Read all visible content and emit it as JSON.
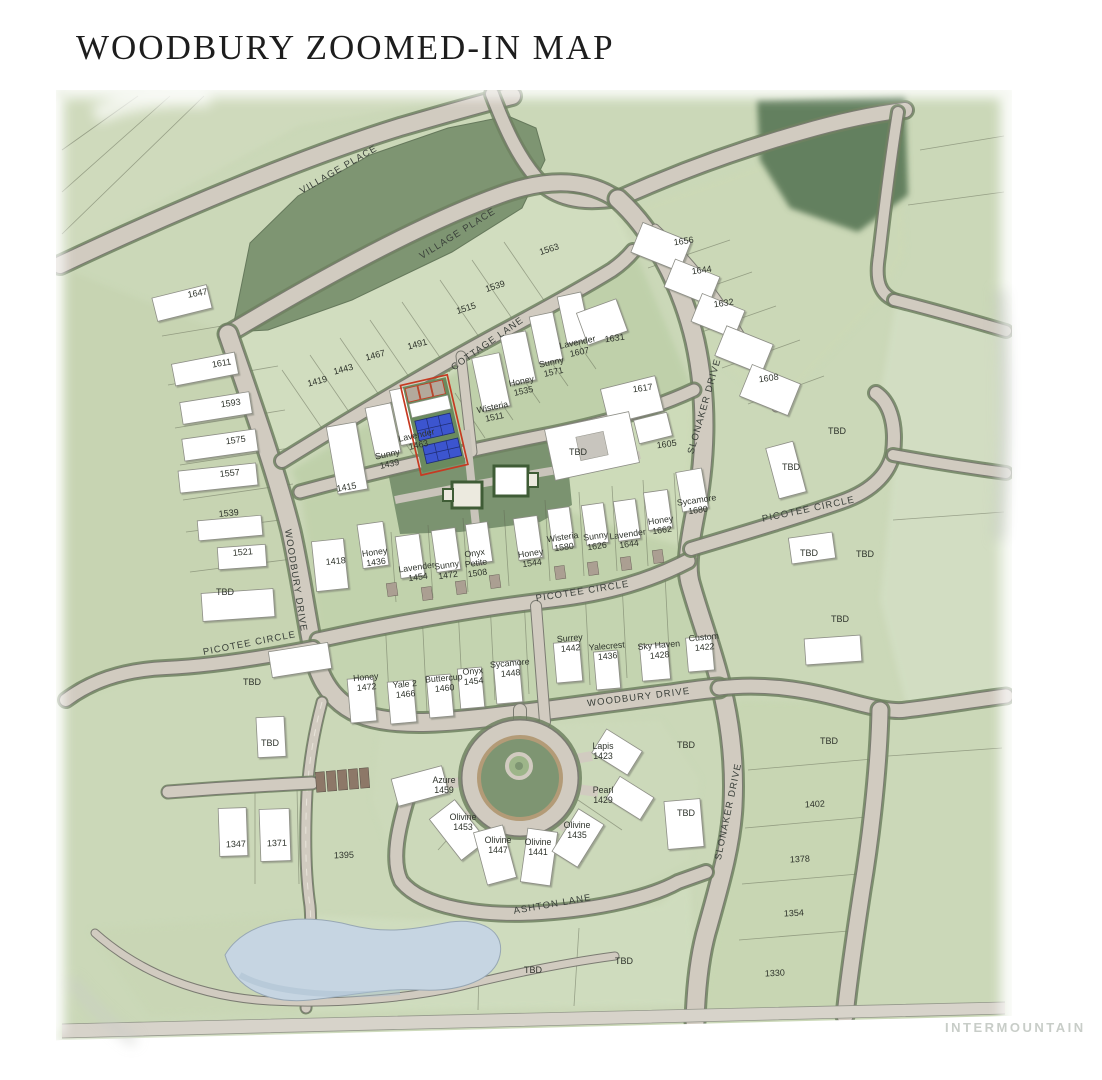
{
  "title": "WOODBURY ZOOMED-IN MAP",
  "watermark": "INTERMOUNTAIN",
  "map": {
    "tbd_label": "TBD",
    "streets": {
      "village_place": "VILLAGE PLACE",
      "cottage_lane": "COTTAGE LANE",
      "slonaker_drive": "SLONAKER DRIVE",
      "woodbury_drive": "WOODBURY DRIVE",
      "picotee_circle": "PICOTEE CIRCLE",
      "ashton_lane": "ASHTON LANE"
    },
    "numbered_lots": {
      "west_column": [
        "1647",
        "1611",
        "1593",
        "1575",
        "1557",
        "1539",
        "1521"
      ],
      "north_fan": [
        "1419",
        "1443",
        "1467",
        "1491",
        "1515",
        "1539",
        "1563"
      ],
      "northeast": [
        "1656",
        "1644",
        "1632",
        "1608"
      ],
      "east_of_center": [
        "1631",
        "1617",
        "1605"
      ],
      "center_west": [
        "1415",
        "1418"
      ],
      "southwest": [
        "1347",
        "1371",
        "1395"
      ],
      "southeast_column": [
        "1402",
        "1378",
        "1354",
        "1330"
      ]
    },
    "named_lots": {
      "cottage_lane_row": [
        {
          "name": "Sunny",
          "number": "1439"
        },
        {
          "name": "Lavender",
          "number": "1463"
        },
        {
          "name": "Wisteria",
          "number": "1511"
        },
        {
          "name": "Honey",
          "number": "1535"
        },
        {
          "name": "Sunny",
          "number": "1571"
        },
        {
          "name": "Lavender",
          "number": "1607"
        }
      ],
      "picotee_north_row": [
        {
          "name": "Honey",
          "number": "1436"
        },
        {
          "name": "Lavender",
          "number": "1454"
        },
        {
          "name": "Sunny",
          "number": "1472"
        },
        {
          "name": "Onyx Petite",
          "number": "1508",
          "display_lines": [
            "Onyx",
            "Petite",
            "1508"
          ]
        },
        {
          "name": "Honey",
          "number": "1544"
        },
        {
          "name": "Wisteria",
          "number": "1580"
        },
        {
          "name": "Sunny",
          "number": "1626"
        },
        {
          "name": "Lavender",
          "number": "1644"
        },
        {
          "name": "Honey",
          "number": "1662"
        },
        {
          "name": "Sycamore",
          "number": "1680"
        }
      ],
      "picotee_south_row": [
        {
          "name": "Honey",
          "number": "1472"
        },
        {
          "name": "Yale 2",
          "number": "1466"
        },
        {
          "name": "Buttercup",
          "number": "1460"
        },
        {
          "name": "Onyx",
          "number": "1454"
        },
        {
          "name": "Sycamore",
          "number": "1448"
        },
        {
          "name": "Surrey",
          "number": "1442"
        },
        {
          "name": "Yalecrest",
          "number": "1436"
        },
        {
          "name": "Sky Haven",
          "number": "1428"
        },
        {
          "name": "Custom",
          "number": "1422"
        }
      ],
      "village_circle": [
        {
          "name": "Azure",
          "number": "1459"
        },
        {
          "name": "Olivine",
          "number": "1453"
        },
        {
          "name": "Olivine",
          "number": "1447"
        },
        {
          "name": "Olivine",
          "number": "1441"
        },
        {
          "name": "Olivine",
          "number": "1435"
        },
        {
          "name": "Pearl",
          "number": "1429"
        },
        {
          "name": "Lapis",
          "number": "1423"
        }
      ]
    },
    "highlight": {
      "outline": "#c63a22",
      "building_fill": "#3c55cf"
    },
    "colors": {
      "wash": "#cbd8b8",
      "park": "#7e9572",
      "forest": "#64805f",
      "plaza": "#7b9370",
      "road": "#d1cbc0",
      "pond": "#c6d5e2",
      "highlight_red": "#c63a22",
      "highlight_blue": "#3c55cf"
    }
  }
}
